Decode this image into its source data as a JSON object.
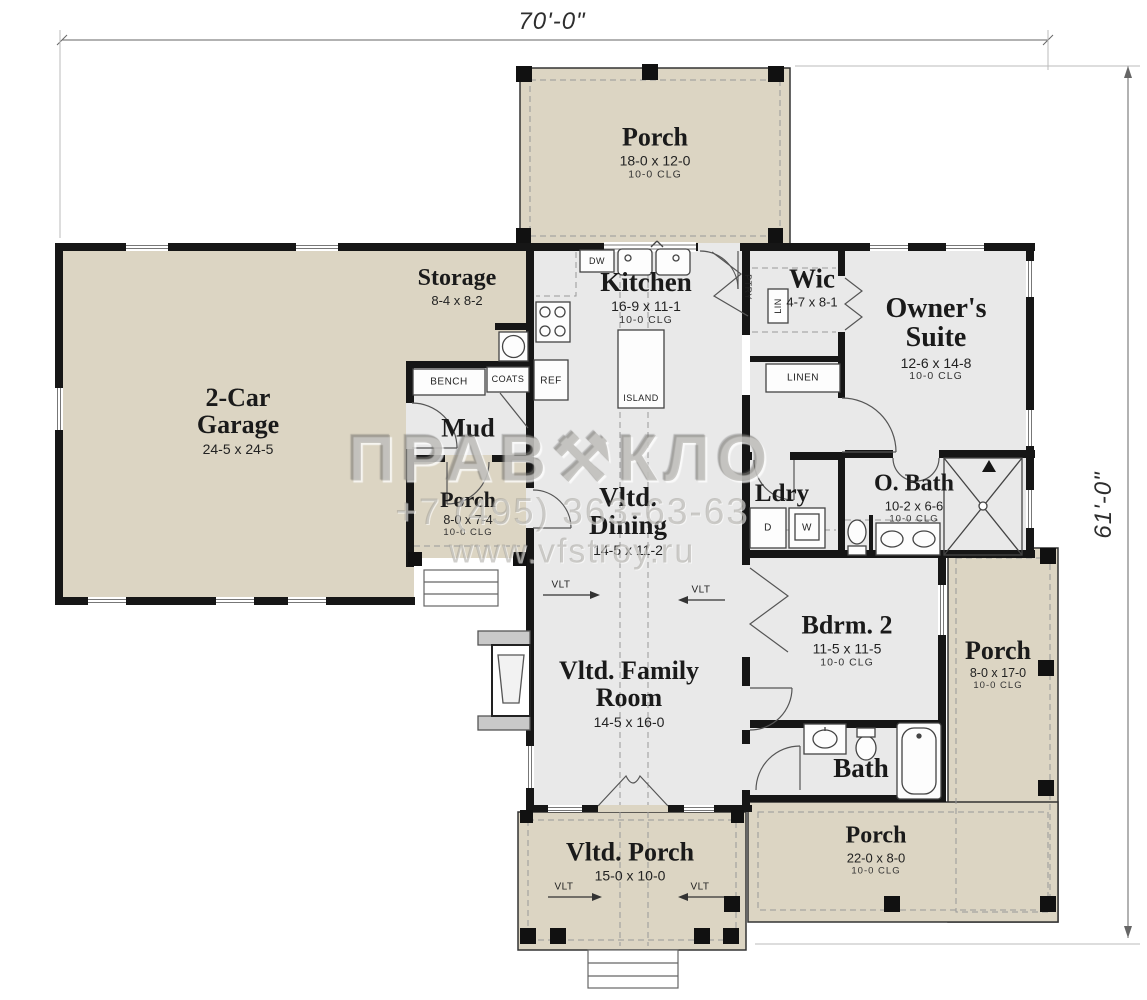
{
  "dimensions": {
    "width_label": "70'-0\"",
    "height_label": "61'-0\""
  },
  "rooms": {
    "porch_top": {
      "name": "Porch",
      "dim": "18-0 x 12-0",
      "clg": "10-0 CLG"
    },
    "storage": {
      "name": "Storage",
      "dim": "8-4 x 8-2"
    },
    "kitchen": {
      "name": "Kitchen",
      "dim": "16-9 x 11-1",
      "clg": "10-0 CLG"
    },
    "wic": {
      "name": "Wic",
      "dim": "4-7 x 8-1"
    },
    "owners_suite": {
      "name": "Owner's Suite",
      "dim": "12-6 x 14-8",
      "clg": "10-0 CLG"
    },
    "garage": {
      "name": "2-Car Garage",
      "dim": "24-5 x 24-5"
    },
    "mud": {
      "name": "Mud"
    },
    "porch_left": {
      "name": "Porch",
      "dim": "8-0 x 7-4",
      "clg": "10-0 CLG"
    },
    "dining": {
      "name": "Vltd. Dining",
      "dim": "14-5 x 11-2"
    },
    "laundry": {
      "name": "Ldry"
    },
    "owners_bath": {
      "name": "O. Bath",
      "dim": "10-2 x 6-6",
      "clg": "10-0 CLG"
    },
    "bedroom2": {
      "name": "Bdrm. 2",
      "dim": "11-5 x 11-5",
      "clg": "10-0 CLG"
    },
    "porch_right": {
      "name": "Porch",
      "dim": "8-0 x 17-0",
      "clg": "10-0 CLG"
    },
    "family": {
      "name": "Vltd. Family Room",
      "dim": "14-5 x 16-0"
    },
    "bath2": {
      "name": "Bath"
    },
    "vltd_porch": {
      "name": "Vltd. Porch",
      "dim": "15-0 x 10-0"
    },
    "porch_bottom": {
      "name": "Porch",
      "dim": "22-0 x 8-0",
      "clg": "10-0 CLG"
    }
  },
  "fixtures": {
    "dw": "DW",
    "pantry": "PTRY",
    "bench": "BENCH",
    "coats": "COATS",
    "ref": "REF",
    "island": "ISLAND",
    "lin": "LIN",
    "linen": "LINEN",
    "dryer": "D",
    "washer": "W",
    "vault": "VLT"
  },
  "watermark": {
    "brand_left": "ПРАВ",
    "brand_symbol": "⚒",
    "brand_right": "КЛО",
    "phone": "+7 (495) 363-63-63",
    "website": "www.vfstroy.ru"
  },
  "colors": {
    "porch_fill": "#dcd5c3",
    "room_fill": "#e9e9e9",
    "wall": "#161616"
  }
}
